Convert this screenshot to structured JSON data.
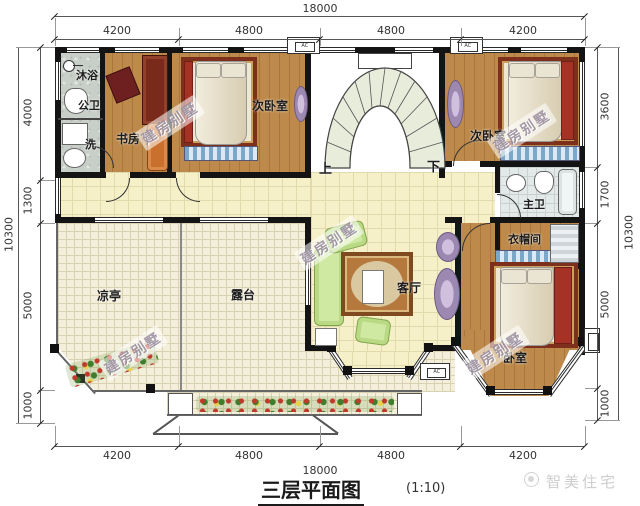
{
  "title": {
    "name": "三层平面图",
    "scale": "(1:10)"
  },
  "dims": {
    "top_overall": "18000",
    "top_segments": [
      "4200",
      "4800",
      "4800",
      "4200"
    ],
    "bottom_segments": [
      "4200",
      "4800",
      "4800",
      "4200"
    ],
    "bottom_overall": "18000",
    "left_overall": "10300",
    "left_segments": [
      "4000",
      "1300",
      "5000",
      "1000"
    ],
    "right_overall": "10300",
    "right_segments": [
      "3600",
      "1700",
      "5000",
      "1000"
    ]
  },
  "rooms": {
    "shower": "沐浴",
    "public_bath": "公卫",
    "laundry": "洗",
    "study": "书房",
    "bedroom_left": "次卧室",
    "bedroom_right": "次卧室",
    "master_bath": "主卫",
    "cloakroom": "衣帽间",
    "living": "客厅",
    "master_bedroom": "卧室",
    "pavilion": "凉亭",
    "terrace": "露台"
  },
  "stairs": {
    "up": "上",
    "down": "下"
  },
  "ac_label": "AC",
  "watermark": {
    "stamp": "建房别墅",
    "logo": "智美住宅"
  },
  "colors": {
    "wall": "#141414",
    "wood": "#bd8a4b",
    "tile": "#f6f0c9",
    "accent_red": "#a63226"
  }
}
